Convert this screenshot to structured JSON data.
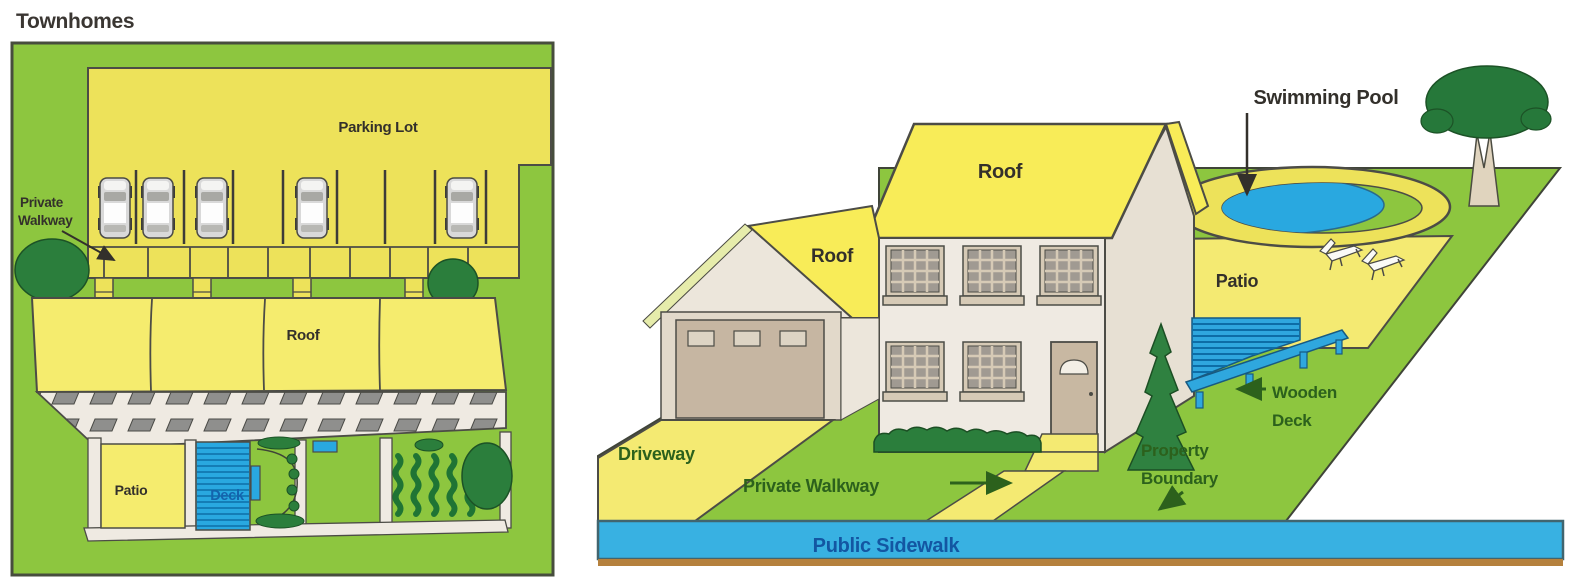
{
  "colors": {
    "lawn_green": "#8DC63F",
    "dark_foliage_green": "#2B7E3C",
    "yellow_paved": "#EDE25A",
    "yellow_roof_left": "#F5EC6E",
    "yellow_roof_right": "#F8EC58",
    "yellow_patio_right": "#F4EA72",
    "water_blue": "#29A8E0",
    "sidewalk_blue": "#38B1E2",
    "building_white": "#EFEAE2",
    "garage_door_tan": "#C6B6A2",
    "outline_dark": "#4C4C46",
    "label_dark": "#33302B",
    "label_green": "#2C611C",
    "label_blue": "#1356A2",
    "deck_label_blue": "#1464AD"
  },
  "townhomes": {
    "title": "Townhomes",
    "labels": {
      "parking_lot": "Parking Lot",
      "private_walkway_line1": "Private",
      "private_walkway_line2": "Walkway",
      "roof": "Roof",
      "patio": "Patio",
      "deck": "Deck"
    },
    "parked_cars_count": 5,
    "townhome_units": 4
  },
  "single_family_home": {
    "labels": {
      "swimming_pool": "Swimming Pool",
      "roof_main": "Roof",
      "roof_garage": "Roof",
      "patio": "Patio",
      "wooden_deck_line1": "Wooden",
      "wooden_deck_line2": "Deck",
      "property_boundary_line1": "Property",
      "property_boundary_line2": "Boundary",
      "driveway": "Driveway",
      "private_walkway": "Private Walkway",
      "public_sidewalk": "Public Sidewalk"
    },
    "lounge_chairs_count": 2
  }
}
